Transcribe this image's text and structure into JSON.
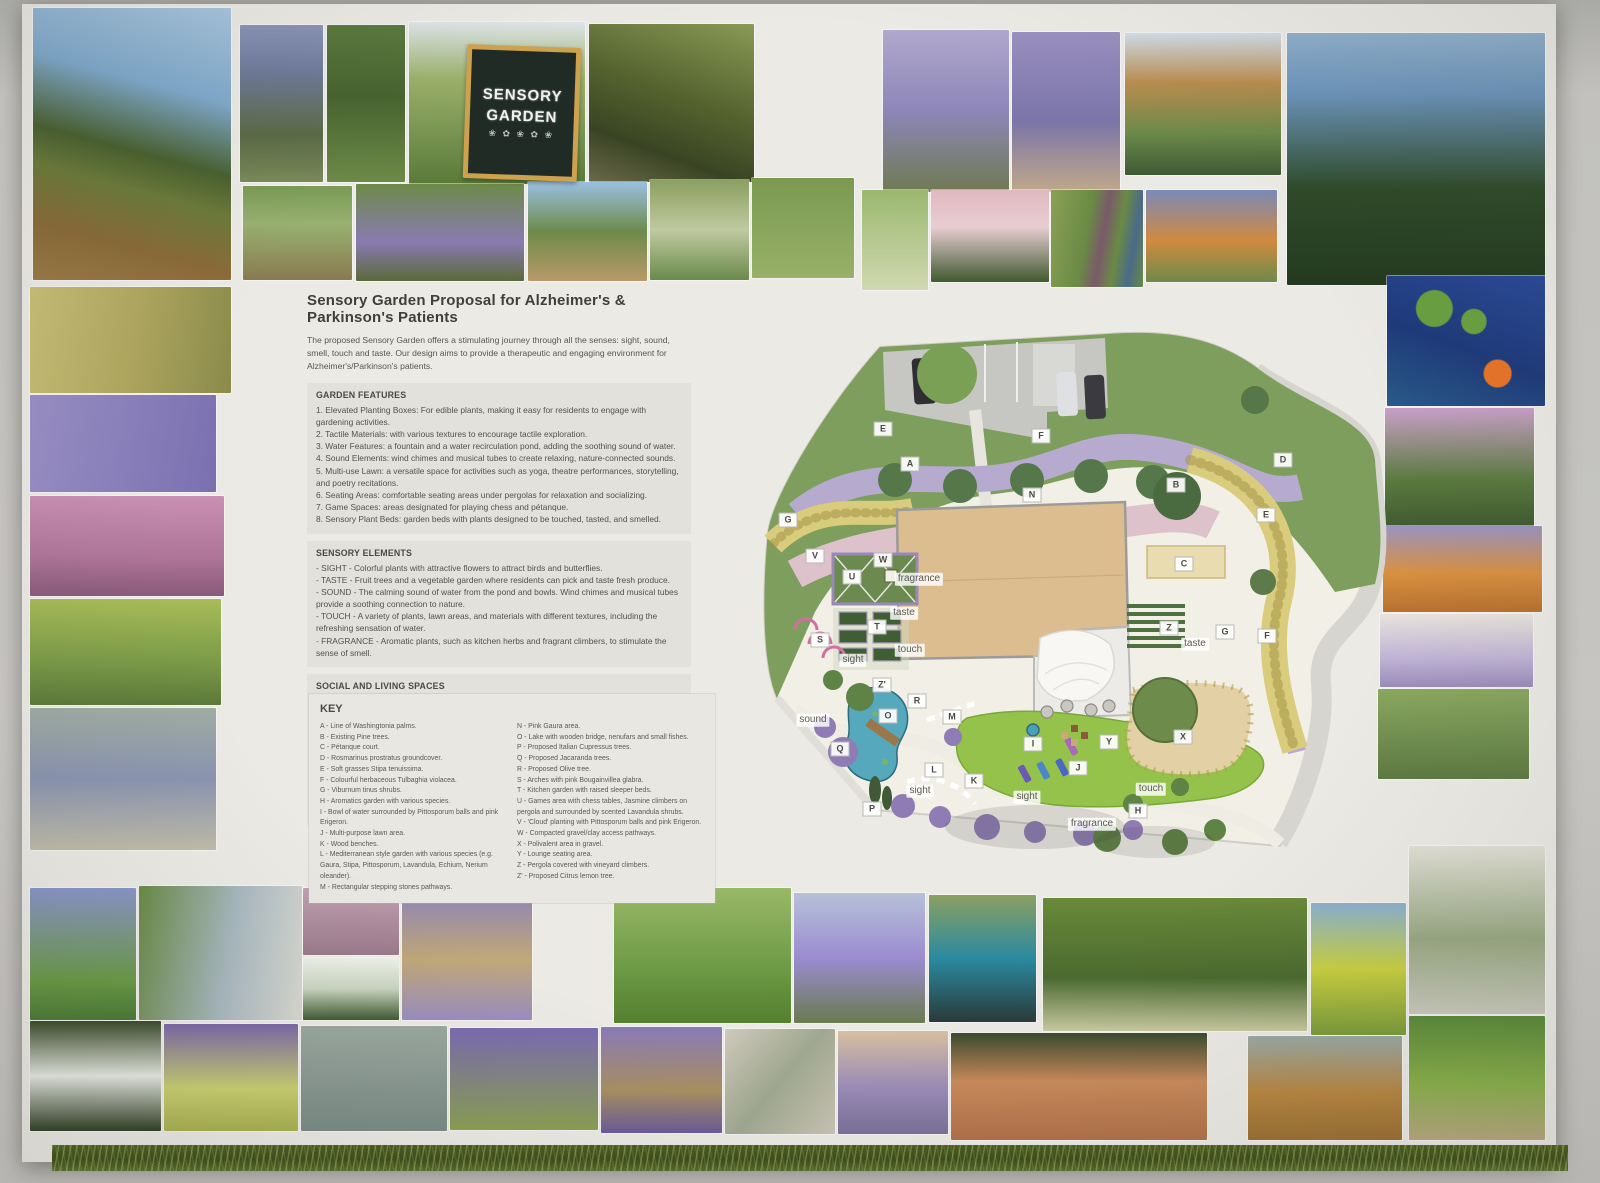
{
  "poster": {
    "title": "Sensory Garden Proposal for Alzheimer's & Parkinson's Patients",
    "intro": "The proposed Sensory Garden offers a stimulating journey through all the senses: sight, sound, smell, touch and taste. Our design aims to provide a therapeutic and engaging environment for Alzheimer's/Parkinson's patients.",
    "sections": [
      {
        "heading": "GARDEN FEATURES",
        "style": "plain",
        "items": [
          "1. Elevated Planting Boxes: For edible plants, making it easy for residents to engage with gardening activities.",
          "2. Tactile Materials: with various textures to encourage tactile exploration.",
          "3. Water Features: a fountain and a water recirculation pond, adding the soothing sound of water.",
          "4. Sound Elements: wind chimes and musical tubes to create relaxing, nature-connected sounds.",
          "5. Multi-use Lawn: a versatile space for activities such as yoga, theatre performances, storytelling, and poetry recitations.",
          "6. Seating Areas: comfortable seating areas under pergolas for relaxation and socializing.",
          "7. Game Spaces: areas designated for playing chess and pétanque.",
          "8. Sensory Plant Beds: garden beds with plants designed to be touched, tasted, and smelled."
        ]
      },
      {
        "heading": "SENSORY ELEMENTS",
        "style": "dashed",
        "items": [
          "SIGHT - Colorful plants with attractive flowers to attract birds and butterflies.",
          "TASTE - Fruit trees and a vegetable garden where residents can pick and taste fresh produce.",
          "SOUND - The calming sound of water from the pond and bowls. Wind chimes and musical tubes provide a soothing connection to nature.",
          "TOUCH - A variety of plants, lawn areas, and materials with different textures, including the refreshing sensation of water.",
          "FRAGRANCE - Aromatic plants, such as kitchen herbs and fragrant climbers, to stimulate the sense of smell."
        ]
      },
      {
        "heading": "SOCIAL AND LIVING SPACES",
        "style": "dashed",
        "items": [
          "Games area: Chess tables and pétanque courts for recreational activities.",
          "Social Spaces: Areas for socializing with tables and chairs where you can meet, talk and do group activities",
          "Regular Activities: Scheduled activities like gymnastics and yoga sessions.",
          "Therapeutic Activities: Music therapy, theatre performances, poetry readings, and storytelling sessions.",
          "Sensory Walks: Guided tours that engage various senses.",
          "Community Participation: Involving local community members and volunteers in interactions with residents.",
          "Art and Handicrafts: Incorporating art pieces and resident-created crafts throughout the garden."
        ]
      }
    ],
    "key": {
      "heading": "KEY",
      "col1": [
        "A - Line of Washingtonia palms.",
        "B - Existing Pine trees.",
        "C - Pétanque court.",
        "D - Rosmarinus prostratus groundcover.",
        "E - Soft grasses Stipa tenuissima.",
        "F - Colourful herbaceous Tulbaghia violacea.",
        "G - Viburnum tinus shrubs.",
        "H - Aromatics garden with various species.",
        "I - Bowl of water surrounded by Pittosporum balls and pink Erigeron.",
        "J - Multi-purpose lawn area.",
        "K - Wood benches.",
        "L - Mediterranean style garden with various species (e.g. Gaura, Stipa, Pittosporum, Lavandula, Echium, Nerium oleander).",
        "M - Rectangular stepping stones pathways."
      ],
      "col2": [
        "N - Pink Gaura area.",
        "O - Lake with wooden bridge, nenufars and small fishes.",
        "P - Proposed Italian Cupressus trees.",
        "Q - Proposed Jacaranda trees.",
        "R - Proposed Olive tree.",
        "S - Arches with pink Bougainvillea glabra.",
        "T - Kitchen garden with raised sleeper beds.",
        "U - Games area with chess tables, Jasmine climbers on pergola and surrounded by scented Lavandula shrubs.",
        "V - 'Cloud' planting with Pittosporum balls and pink Erigeron.",
        "W - Compacted gravel/clay access pathways.",
        "X - Polivalent area in gravel.",
        "Y - Lounge seating area.",
        "Z - Pergola covered with vineyard climbers.",
        "Z' - Proposed Citrus lemon tree."
      ]
    }
  },
  "chalkboard": {
    "line1": "SENSORY",
    "line2": "GARDEN",
    "plants": "❀ ✿ ❀ ✿ ❀"
  },
  "plan": {
    "letters": [
      {
        "t": "E",
        "x": 148,
        "y": 147
      },
      {
        "t": "A",
        "x": 175,
        "y": 182
      },
      {
        "t": "F",
        "x": 306,
        "y": 154
      },
      {
        "t": "N",
        "x": 297,
        "y": 213
      },
      {
        "t": "B",
        "x": 441,
        "y": 203
      },
      {
        "t": "D",
        "x": 548,
        "y": 178
      },
      {
        "t": "E",
        "x": 531,
        "y": 233
      },
      {
        "t": "C",
        "x": 449,
        "y": 282
      },
      {
        "t": "V",
        "x": 80,
        "y": 274
      },
      {
        "t": "W",
        "x": 148,
        "y": 278
      },
      {
        "t": "U",
        "x": 117,
        "y": 295
      },
      {
        "t": "T",
        "x": 142,
        "y": 345
      },
      {
        "t": "S",
        "x": 85,
        "y": 358
      },
      {
        "t": "G",
        "x": 53,
        "y": 238
      },
      {
        "t": "Z",
        "x": 434,
        "y": 346
      },
      {
        "t": "G",
        "x": 490,
        "y": 350
      },
      {
        "t": "F",
        "x": 532,
        "y": 354
      },
      {
        "t": "Z'",
        "x": 147,
        "y": 403
      },
      {
        "t": "R",
        "x": 182,
        "y": 419
      },
      {
        "t": "O",
        "x": 153,
        "y": 434
      },
      {
        "t": "M",
        "x": 217,
        "y": 435
      },
      {
        "t": "Q",
        "x": 105,
        "y": 467
      },
      {
        "t": "L",
        "x": 199,
        "y": 488
      },
      {
        "t": "K",
        "x": 239,
        "y": 499
      },
      {
        "t": "I",
        "x": 298,
        "y": 462
      },
      {
        "t": "Y",
        "x": 374,
        "y": 460
      },
      {
        "t": "J",
        "x": 343,
        "y": 486
      },
      {
        "t": "X",
        "x": 448,
        "y": 455
      },
      {
        "t": "H",
        "x": 403,
        "y": 529
      },
      {
        "t": "P",
        "x": 137,
        "y": 527
      }
    ],
    "senses": [
      {
        "t": "fragrance",
        "x": 184,
        "y": 297
      },
      {
        "t": "taste",
        "x": 169,
        "y": 331
      },
      {
        "t": "taste",
        "x": 460,
        "y": 362
      },
      {
        "t": "touch",
        "x": 175,
        "y": 368
      },
      {
        "t": "sight",
        "x": 118,
        "y": 378
      },
      {
        "t": "sound",
        "x": 78,
        "y": 438
      },
      {
        "t": "sight",
        "x": 185,
        "y": 509
      },
      {
        "t": "sight",
        "x": 292,
        "y": 515
      },
      {
        "t": "fragrance",
        "x": 357,
        "y": 542
      },
      {
        "t": "touch",
        "x": 416,
        "y": 507
      }
    ]
  },
  "photos": [
    {
      "n": "palm-tree-photo",
      "x": 33,
      "y": 8,
      "w": 198,
      "h": 272,
      "g": "linear-gradient(195deg,#a8c6de 0%,#7fa9cc 30%,#49602f 52%,#6b7a3a 64%,#8a6a38 82%,#9a7a45 100%)"
    },
    {
      "n": "water-bowl-iris-photo",
      "x": 240,
      "y": 25,
      "w": 83,
      "h": 157,
      "g": "linear-gradient(180deg,#8a94b8 0%,#6f7a9a 30%,#5a6a45 70%,#7a8a5a 100%)"
    },
    {
      "n": "wind-chime-photo",
      "x": 327,
      "y": 25,
      "w": 78,
      "h": 157,
      "g": "linear-gradient(180deg,#5a7a3f 0%,#47632f 45%,#6d8a48 100%)"
    },
    {
      "n": "sensory-garden-sign-photo",
      "x": 409,
      "y": 22,
      "w": 176,
      "h": 162,
      "g": "linear-gradient(180deg,#dfe6ea 0%,#9ab06a 35%,#5a7a3a 100%)"
    },
    {
      "n": "raised-beds-photo",
      "x": 589,
      "y": 24,
      "w": 165,
      "h": 158,
      "g": "linear-gradient(200deg,#8a9a55 0%,#55632f 45%,#3a4424 75%,#6a6a4a 100%)"
    },
    {
      "n": "smelling-lavender-photo",
      "x": 883,
      "y": 30,
      "w": 126,
      "h": 162,
      "g": "linear-gradient(180deg,#b0a8cc 0%,#8d86b8 50%,#6f7a52 100%)"
    },
    {
      "n": "touching-lavender-photo",
      "x": 1012,
      "y": 32,
      "w": 108,
      "h": 160,
      "g": "linear-gradient(180deg,#9a90c0 0%,#7a74a8 55%,#c0a88a 100%)"
    },
    {
      "n": "pergola-lakeside-photo",
      "x": 1125,
      "y": 33,
      "w": 156,
      "h": 142,
      "g": "linear-gradient(180deg,#cfdde8 0%,#b98c4f 35%,#6d8a4a 70%,#3f5a35 100%)"
    },
    {
      "n": "cypress-trees-photo",
      "x": 1287,
      "y": 33,
      "w": 258,
      "h": 252,
      "g": "linear-gradient(180deg,#8fb0cc 0%,#6a92b8 25%,#2f4a28 62%,#243a20 100%)"
    },
    {
      "n": "gardening-planters-photo",
      "x": 243,
      "y": 186,
      "w": 109,
      "h": 94,
      "g": "linear-gradient(180deg,#7a9a55 0%,#98b070 40%,#8a7a50 100%)"
    },
    {
      "n": "bench-salvia-photo",
      "x": 356,
      "y": 184,
      "w": 168,
      "h": 97,
      "g": "linear-gradient(180deg,#6d8a48 0%,#8a7ab0 60%,#5a6a3a 100%)"
    },
    {
      "n": "elevated-planter-boxes-photo",
      "x": 528,
      "y": 182,
      "w": 119,
      "h": 99,
      "g": "linear-gradient(180deg,#9ac0e0 0%,#6d8a4a 50%,#b89a68 100%)"
    },
    {
      "n": "meadow-flowers-photo",
      "x": 650,
      "y": 180,
      "w": 99,
      "h": 100,
      "g": "linear-gradient(180deg,#8aa060 0%,#c0c9a0 50%,#6a8a4a 100%)"
    },
    {
      "n": "pond-meadow-photo",
      "x": 752,
      "y": 178,
      "w": 102,
      "h": 100,
      "g": "linear-gradient(180deg,#7a9a50 0%,#98b068 100%)"
    },
    {
      "n": "butterfly-meadow-photo",
      "x": 862,
      "y": 190,
      "w": 66,
      "h": 100,
      "g": "linear-gradient(180deg,#9ab870 0%,#d0d8b0 100%)"
    },
    {
      "n": "pink-roses-photo",
      "x": 931,
      "y": 190,
      "w": 118,
      "h": 92,
      "g": "linear-gradient(180deg,#e0b8c0 0%,#e8cdd2 40%,#3f5a30 100%)"
    },
    {
      "n": "glass-wind-chimes-photo",
      "x": 1051,
      "y": 190,
      "w": 92,
      "h": 97,
      "g": "linear-gradient(100deg,#8aa055 0%,#6a8a45 40%,#7a5a6a 55%,#6a8a45 70%,#4a6a8a 85%,#6a8a45 100%)"
    },
    {
      "n": "flower-planter-photo",
      "x": 1146,
      "y": 190,
      "w": 131,
      "h": 92,
      "g": "linear-gradient(180deg,#7a8ab8 0%,#d08a40 55%,#6d8a4a 100%)"
    },
    {
      "n": "koi-pond-photo",
      "x": 1387,
      "y": 276,
      "w": 158,
      "h": 130,
      "g": "radial-gradient(circle at 70% 75%,#e8742a 0 9%,rgba(0,0,0,0) 10%),radial-gradient(circle at 30% 25%,#6aa040 0 12%,rgba(0,0,0,0) 13%),radial-gradient(circle at 55% 35%,#6aa040 0 10%,rgba(0,0,0,0) 11%),linear-gradient(200deg,#2a4a9a 0%,#1e3a7a 55%,#2a5a8a 100%)"
    },
    {
      "n": "rose-arch-tunnel-photo",
      "x": 1385,
      "y": 408,
      "w": 149,
      "h": 120,
      "g": "linear-gradient(180deg,#c9a0c8 0%,#5a7a3f 60%,#3f5a30 100%)"
    },
    {
      "n": "kniphofia-flowers-photo",
      "x": 1383,
      "y": 526,
      "w": 159,
      "h": 86,
      "g": "linear-gradient(180deg,#9a94c0 0%,#d89040 55%,#b87030 100%)"
    },
    {
      "n": "lavender-dome-photo",
      "x": 1380,
      "y": 614,
      "w": 153,
      "h": 73,
      "g": "linear-gradient(180deg,#e8e4dc 0%,#c0b4d6 60%,#9a8cb8 100%)"
    },
    {
      "n": "mounded-garden-photo",
      "x": 1378,
      "y": 689,
      "w": 151,
      "h": 90,
      "g": "linear-gradient(180deg,#8aa860 0%,#5d7a42 100%)"
    },
    {
      "n": "stipa-grass-photo",
      "x": 30,
      "y": 287,
      "w": 201,
      "h": 106,
      "g": "linear-gradient(100deg,#c9c077 0%,#b0a860 50%,#8a8a4a 100%)"
    },
    {
      "n": "lavender-closeup-photo",
      "x": 30,
      "y": 395,
      "w": 186,
      "h": 97,
      "g": "linear-gradient(100deg,#9a90c8 0%,#7a70b0 100%)"
    },
    {
      "n": "pink-heather-photo",
      "x": 30,
      "y": 496,
      "w": 194,
      "h": 100,
      "g": "linear-gradient(180deg,#c990b4 0%,#b0769a 60%,#8a5a7a 100%)"
    },
    {
      "n": "mound-shrubs-photo",
      "x": 30,
      "y": 599,
      "w": 191,
      "h": 106,
      "g": "linear-gradient(180deg,#a8bc58 0%,#7a9a48 60%,#5d7a3a 100%)"
    },
    {
      "n": "santolina-gravel-photo",
      "x": 30,
      "y": 708,
      "w": 186,
      "h": 142,
      "g": "linear-gradient(180deg,#a0aca4 0%,#8a94b0 50%,#c0bca8 100%)"
    },
    {
      "n": "agapanthus-photo",
      "x": 30,
      "y": 888,
      "w": 106,
      "h": 132,
      "g": "linear-gradient(180deg,#8a94c9 0%,#6a9a45 70%,#4a7a35 100%)"
    },
    {
      "n": "woman-playing-chimes-photo",
      "x": 139,
      "y": 886,
      "w": 163,
      "h": 134,
      "g": "linear-gradient(100deg,#6a8a45 0%,#a8b8c0 55%,#d8d8d0 100%)"
    },
    {
      "n": "pennisetum-grass-photo",
      "x": 303,
      "y": 888,
      "w": 96,
      "h": 67,
      "g": "linear-gradient(180deg,#c0a0b0 0%,#9a7a8a 100%)"
    },
    {
      "n": "jasmine-flowers-photo",
      "x": 303,
      "y": 958,
      "w": 96,
      "h": 62,
      "g": "linear-gradient(180deg,#eef0ea 0%,#c8d4c0 50%,#3f5a30 100%)"
    },
    {
      "n": "lavender-path-photo",
      "x": 402,
      "y": 886,
      "w": 130,
      "h": 134,
      "g": "linear-gradient(180deg,#8a80bc 0%,#c0a876 55%,#9a8cc0 100%)"
    },
    {
      "n": "seniors-yoga-photo",
      "x": 614,
      "y": 888,
      "w": 177,
      "h": 135,
      "g": "linear-gradient(180deg,#98b868 0%,#6d9a45 60%,#55802f 100%)"
    },
    {
      "n": "jacaranda-tree-photo",
      "x": 794,
      "y": 893,
      "w": 131,
      "h": 130,
      "g": "linear-gradient(180deg,#b8c0d8 0%,#9a8cd0 50%,#6a7a50 100%)"
    },
    {
      "n": "blue-water-bowl-photo",
      "x": 929,
      "y": 895,
      "w": 107,
      "h": 127,
      "g": "linear-gradient(180deg,#8aa060 0%,#2a8aa0 50%,#2a3a3a 100%)"
    },
    {
      "n": "citrus-orchard-bench-photo",
      "x": 1043,
      "y": 898,
      "w": 264,
      "h": 133,
      "g": "linear-gradient(180deg,#6a8a3a 0%,#4a6a30 60%,#c9c9a0 100%)"
    },
    {
      "n": "lemons-closeup-photo",
      "x": 1311,
      "y": 903,
      "w": 95,
      "h": 132,
      "g": "linear-gradient(180deg,#8ab0d0 0%,#c9d040 50%,#7a9a3a 100%)"
    },
    {
      "n": "olive-tree-photo",
      "x": 1409,
      "y": 846,
      "w": 136,
      "h": 168,
      "g": "linear-gradient(180deg,#e2e0d6 0%,#98a882 55%,#c9c9bc 100%)"
    },
    {
      "n": "white-hedge-photo",
      "x": 30,
      "y": 1021,
      "w": 131,
      "h": 110,
      "g": "linear-gradient(180deg,#3a4a2a 0%,#e8eae4 50%,#2f3f24 100%)"
    },
    {
      "n": "stipa-salvia-photo",
      "x": 164,
      "y": 1024,
      "w": 134,
      "h": 107,
      "g": "linear-gradient(180deg,#7a68a8 0%,#c9d070 60%,#a8b050 100%)"
    },
    {
      "n": "westringia-shrub-photo",
      "x": 301,
      "y": 1026,
      "w": 146,
      "h": 105,
      "g": "linear-gradient(180deg,#9aa8a0 0%,#7a8a84 100%)"
    },
    {
      "n": "delphinium-garden-photo",
      "x": 450,
      "y": 1028,
      "w": 148,
      "h": 102,
      "g": "linear-gradient(180deg,#7a6ab0 0%,#8aa050 100%)"
    },
    {
      "n": "bench-lavender-photo",
      "x": 601,
      "y": 1027,
      "w": 121,
      "h": 106,
      "g": "linear-gradient(180deg,#8a7ab8 0%,#a89060 60%,#6a5a9a 100%)"
    },
    {
      "n": "stone-slab-path-photo",
      "x": 725,
      "y": 1029,
      "w": 110,
      "h": 105,
      "g": "linear-gradient(130deg,#cfcabc 0%,#a0a890 50%,#c9c4b4 100%)"
    },
    {
      "n": "lavender-field-rows-photo",
      "x": 838,
      "y": 1031,
      "w": 110,
      "h": 103,
      "g": "linear-gradient(180deg,#d8c0a0 0%,#9a8cb8 55%,#7a7098 100%)"
    },
    {
      "n": "petanque-court-photo",
      "x": 951,
      "y": 1033,
      "w": 256,
      "h": 107,
      "g": "linear-gradient(180deg,#3a4a30 0%,#c98a5a 45%,#b0704a 100%)"
    },
    {
      "n": "chess-table-chairs-photo",
      "x": 1248,
      "y": 1036,
      "w": 154,
      "h": 104,
      "g": "linear-gradient(180deg,#9aa8a4 0%,#b8863f 55%,#9a6f33 100%)"
    },
    {
      "n": "vegetable-beds-photo",
      "x": 1409,
      "y": 1016,
      "w": 136,
      "h": 124,
      "g": "linear-gradient(180deg,#5a8a3a 0%,#8ab04a 55%,#b8a880 100%)"
    }
  ]
}
